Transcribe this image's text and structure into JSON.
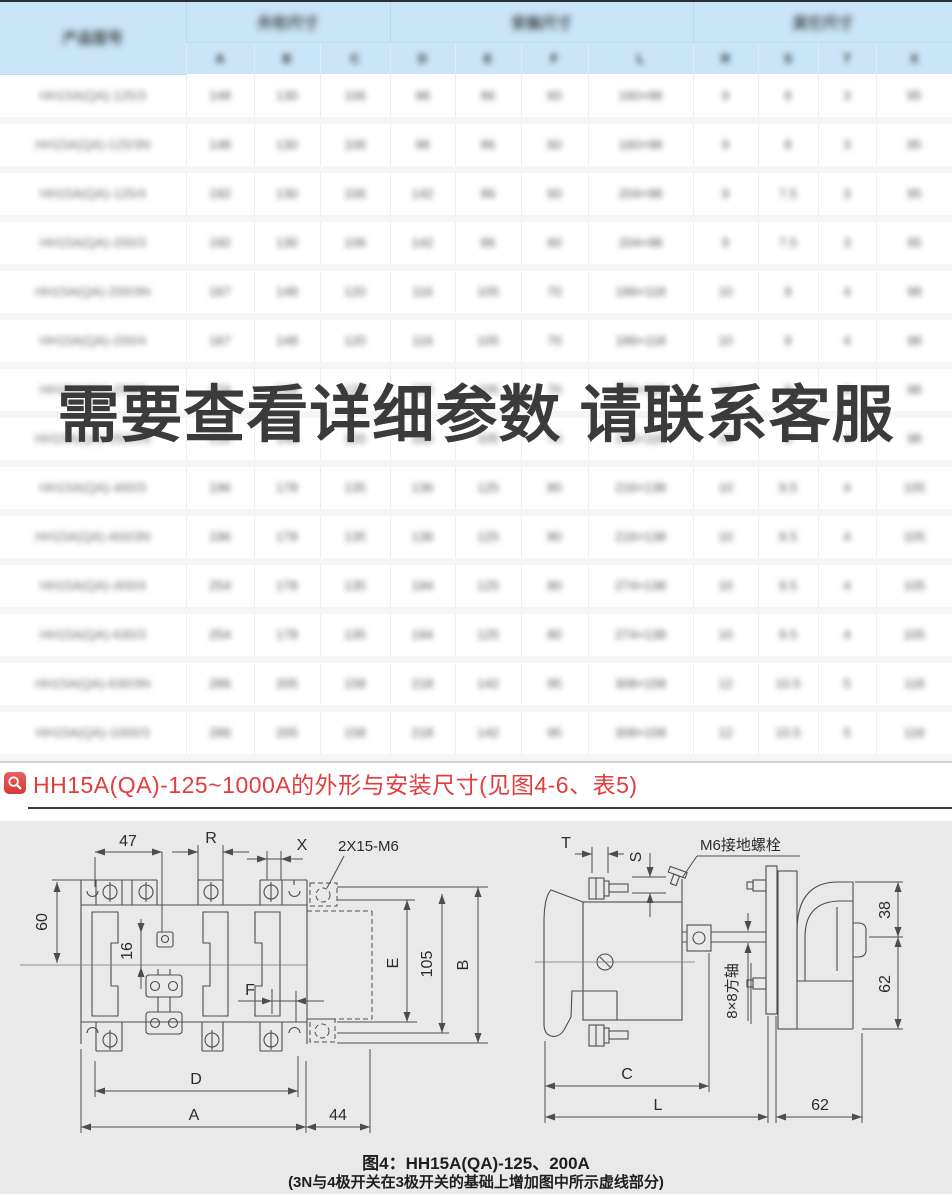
{
  "table": {
    "model_header": "产品型号",
    "groups": [
      {
        "label": "外形尺寸",
        "span": 3
      },
      {
        "label": "安装尺寸",
        "span": 4
      },
      {
        "label": "其它尺寸",
        "span": 4
      }
    ],
    "sub_headers": [
      "A",
      "B",
      "C",
      "D",
      "E",
      "F",
      "L",
      "R",
      "S",
      "T",
      "X"
    ],
    "rows": [
      {
        "model": "HH15A(QA)-125/3",
        "values": [
          "148",
          "130",
          "106",
          "98",
          "86",
          "60",
          "160×98",
          "9",
          "8",
          "3",
          "95"
        ]
      },
      {
        "model": "HH15A(QA)-125/3N",
        "values": [
          "148",
          "130",
          "106",
          "98",
          "86",
          "60",
          "160×98",
          "9",
          "8",
          "3",
          "95"
        ]
      },
      {
        "model": "HH15A(QA)-125/4",
        "values": [
          "192",
          "130",
          "106",
          "142",
          "86",
          "60",
          "204×98",
          "9",
          "7.5",
          "3",
          "95"
        ]
      },
      {
        "model": "HH15A(QA)-200/3",
        "values": [
          "192",
          "130",
          "106",
          "142",
          "86",
          "60",
          "204×98",
          "9",
          "7.5",
          "3",
          "95"
        ]
      },
      {
        "model": "HH15A(QA)-200/3N",
        "values": [
          "167",
          "148",
          "120",
          "116",
          "105",
          "70",
          "186×118",
          "10",
          "9",
          "4",
          "98"
        ]
      },
      {
        "model": "HH15A(QA)-200/4",
        "values": [
          "167",
          "148",
          "120",
          "116",
          "105",
          "70",
          "186×118",
          "10",
          "9",
          "4",
          "98"
        ]
      },
      {
        "model": "HH15A(QA)-250/3",
        "values": [
          "216",
          "148",
          "120",
          "165",
          "105",
          "70",
          "235×118",
          "10",
          "9",
          "4",
          "98"
        ]
      },
      {
        "model": "HH15A(QA)-250/3N",
        "values": [
          "216",
          "148",
          "120",
          "165",
          "105",
          "70",
          "235×118",
          "10",
          "9",
          "4",
          "98"
        ]
      },
      {
        "model": "HH15A(QA)-400/3",
        "values": [
          "196",
          "178",
          "135",
          "136",
          "125",
          "80",
          "216×138",
          "10",
          "9.5",
          "4",
          "105"
        ]
      },
      {
        "model": "HH15A(QA)-400/3N",
        "values": [
          "196",
          "178",
          "135",
          "136",
          "125",
          "80",
          "216×138",
          "10",
          "9.5",
          "4",
          "105"
        ]
      },
      {
        "model": "HH15A(QA)-400/4",
        "values": [
          "254",
          "178",
          "135",
          "194",
          "125",
          "80",
          "274×138",
          "10",
          "9.5",
          "4",
          "105"
        ]
      },
      {
        "model": "HH15A(QA)-630/3",
        "values": [
          "254",
          "178",
          "135",
          "194",
          "125",
          "80",
          "274×138",
          "10",
          "9.5",
          "4",
          "105"
        ]
      },
      {
        "model": "HH15A(QA)-630/3N",
        "values": [
          "286",
          "205",
          "158",
          "218",
          "142",
          "95",
          "308×158",
          "12",
          "10.5",
          "5",
          "118"
        ]
      },
      {
        "model": "HH15A(QA)-1000/3",
        "values": [
          "286",
          "205",
          "158",
          "218",
          "142",
          "95",
          "308×158",
          "12",
          "10.5",
          "5",
          "118"
        ]
      }
    ]
  },
  "watermark": "需要查看详细参数 请联系客服",
  "section": {
    "title": "HH15A(QA)-125~1000A的外形与安装尺寸(见图4-6、表5)"
  },
  "diagram": {
    "left": {
      "d47": "47",
      "dR": "R",
      "dX": "X",
      "d2x15": "2X15-M6",
      "d60": "60",
      "d16": "16",
      "dF": "F",
      "dE": "E",
      "d105": "105",
      "dB": "B",
      "dD": "D",
      "dA": "A",
      "d44": "44"
    },
    "right": {
      "dT": "T",
      "dS": "S",
      "ground": "M6接地螺栓",
      "shaft": "8×8方轴",
      "d38": "38",
      "d62": "62",
      "dC": "C",
      "dL": "L",
      "d62b": "62"
    },
    "caption_line1": "图4：HH15A(QA)-125、200A",
    "caption_line2": "(3N与4极开关在3极开关的基础上增加图中所示虚线部分)"
  }
}
